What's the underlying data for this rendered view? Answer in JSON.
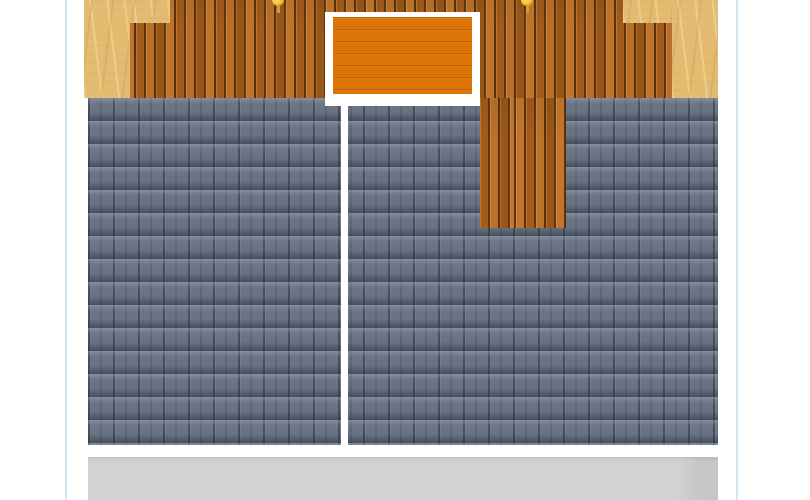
{
  "scene": {
    "type": "top-down building plan",
    "regions": {
      "deck": "wood deck planks",
      "plywood": "unfinished plywood subfloor corners",
      "tiles": "blue-gray roof tile grid",
      "skylight": "orange framed skylight panel",
      "divider": "white seam line",
      "apron": "concrete apron strip",
      "pins": "gold marker pins (cut off at top edge)"
    }
  },
  "colors": {
    "canvas-bg": "#ffffff",
    "guide-line": "#9cc8e0",
    "deck-base": "#b2661f",
    "plywood-base": "#e3bc72",
    "skylight-fill": "#dc7407",
    "skylight-frame": "#ffffff",
    "tile-base": "#6a7383",
    "divider": "#ffffff",
    "apron": "#d2d2d2",
    "pin-gold": "#f2cb47",
    "pin-gold-rim": "#c2891c",
    "pin-stem": "#caa035"
  }
}
